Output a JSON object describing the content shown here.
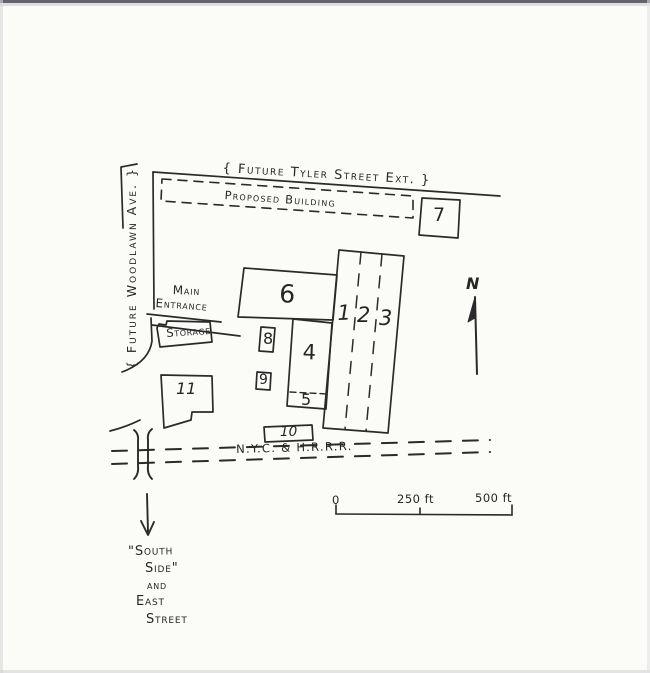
{
  "title": "Hand-drawn factory site plan",
  "streets": {
    "tyler": "{ Future Tyler Street Ext. }",
    "woodlawn": "{ Future Woodlawn Ave. }",
    "railroad": "N.Y.C. & H.R.R.R.",
    "south_block": {
      "line1": "\"South",
      "line2": "Side\"",
      "line3": "and",
      "line4": "East",
      "line5": "Street"
    }
  },
  "labels": {
    "proposed_building": "Proposed Building",
    "main_entrance_line1": "Main",
    "main_entrance_line2": "Entrance",
    "storage": "Storage",
    "north": "N"
  },
  "buildings": {
    "b1": "1",
    "b2": "2",
    "b3": "3",
    "b4": "4",
    "b5": "5",
    "b6": "6",
    "b7": "7",
    "b8": "8",
    "b9": "9",
    "b10": "10",
    "b11": "11"
  },
  "scale_bar": {
    "start": "0",
    "middle": "250 ft",
    "end": "500 ft"
  },
  "colors": {
    "ink": "#2a2a2a",
    "paper": "#fbfbf8"
  }
}
